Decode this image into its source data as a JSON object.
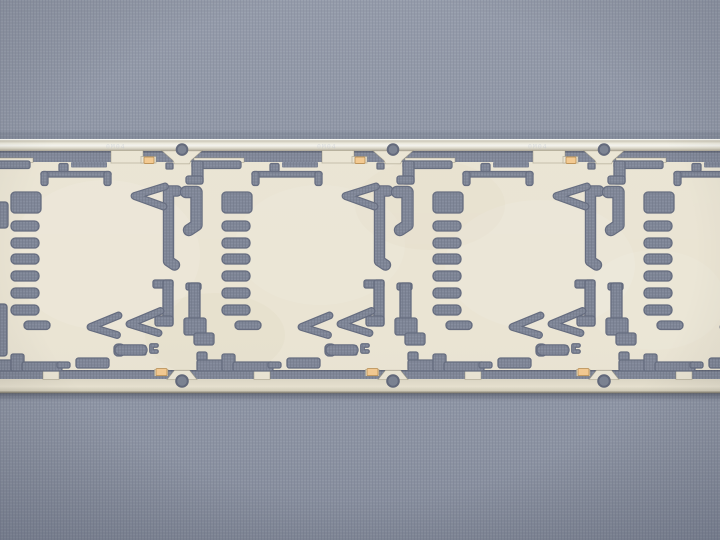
{
  "photo": {
    "kind": "macro photograph of an etched metal lead-frame carrier strip on woven gray paper",
    "width": 720,
    "height": 540,
    "rail_mark_text": "0M04"
  },
  "colors": {
    "bg_base": "#8e95a4",
    "bg_weave_light": "#9aa1b0",
    "bg_weave_dark": "#808798",
    "cut_base": "#7e8596",
    "cut_weave_light": "#8a91a1",
    "cut_weave_dark": "#6f7687",
    "cut_edge": "#646b7e",
    "cream": "#eae4d3",
    "cream_edge": "rgba(150,142,118,0.55)",
    "rail_stops": [
      "#a8a290",
      "#c9c4b3",
      "#edebdf",
      "#f3f2ec",
      "#d8d4c4",
      "#a9a393"
    ],
    "brail_stops": [
      "#ddd7c5",
      "#e7e1cf",
      "#d0cab7",
      "#a39d8b"
    ],
    "rail_highlight": "#f6f6f2",
    "pad_fill": "#f3c98f",
    "pad_edge": "#bd9257",
    "hole_fill": "#798090",
    "hole_edge": "#5f6678",
    "slot_shadow": "rgba(40,45,60,0.32)",
    "strip_shadow": "rgba(45,50,65,0.45)",
    "above_shadow": "rgba(50,55,70,0.12)",
    "bottom_edge_line": "#8f8a7b",
    "mark_fill": "#b9bfcc",
    "mottle_light": "#ffffff",
    "mottle_tan": "#d8cdae",
    "vignette": "rgba(28,33,52,0.15)"
  },
  "strip": {
    "top": 139,
    "bottom": 393,
    "rail_top_y": 139,
    "rail_top_h": 12,
    "slot_top_y": 151,
    "slot_top_h": 11,
    "slot_bot_y": 370,
    "slot_bot_h": 9,
    "rail_bot_y": 379,
    "rail_bot_h": 14,
    "shadow_h": 8
  },
  "units": {
    "pitch": 211,
    "boundaries": [
      -29,
      182,
      393,
      604
    ]
  },
  "unit": {
    "fills": [
      [
        10,
        161,
        49,
        7.5,
        2
      ],
      [
        10,
        161,
        11,
        23,
        2
      ],
      [
        4,
        176,
        17,
        8,
        2.5
      ],
      [
        70,
        171.5,
        70,
        5.5,
        2.5
      ],
      [
        70,
        171.5,
        7,
        14,
        2.5
      ],
      [
        133,
        171.5,
        7,
        14,
        2.5
      ],
      [
        88,
        163.5,
        9,
        8,
        1.5
      ],
      [
        40,
        192,
        30,
        21,
        4
      ],
      [
        40,
        221,
        28,
        10,
        4.5
      ],
      [
        40,
        238,
        28,
        10,
        4.5
      ],
      [
        40,
        254,
        28,
        10,
        4.5
      ],
      [
        40,
        271,
        28,
        10,
        4.5
      ],
      [
        40,
        288,
        28,
        10,
        4.5
      ],
      [
        40,
        305,
        28,
        10,
        4.5
      ],
      [
        53,
        321,
        26,
        8.5,
        4
      ],
      [
        195,
        163,
        7,
        6,
        1
      ],
      [
        4,
        283,
        15,
        7,
        2
      ],
      [
        7,
        283,
        11,
        39,
        2
      ],
      [
        2,
        318,
        22,
        17,
        2.5
      ],
      [
        12,
        333,
        20,
        12,
        2.5
      ],
      [
        182,
        280,
        20,
        8,
        2
      ],
      [
        192,
        280,
        10,
        46,
        2
      ],
      [
        184,
        316,
        18,
        10,
        2.5
      ],
      [
        15,
        352,
        10,
        9,
        2
      ],
      [
        15,
        360,
        33,
        11,
        2
      ],
      [
        40,
        354,
        13,
        17,
        2
      ],
      [
        51,
        362,
        40,
        9,
        2
      ],
      [
        86,
        362,
        13,
        6,
        2
      ],
      [
        105,
        358,
        33,
        10,
        2.5
      ],
      [
        143,
        344,
        10.5,
        12,
        4
      ],
      [
        170.5,
        345.5,
        4.5,
        9.5,
        1.5
      ]
    ],
    "strokes": [
      {
        "d": "M4 192 H14.5 V225 L7 230",
        "w": 10
      },
      {
        "d": "M206 191 H197.5 V261 L203.5 265",
        "w": 9
      },
      {
        "d": "M194 186.5 L163.5 196 L192.5 206.5",
        "w": 5.5
      },
      {
        "d": "M147.5 315.5 L119.5 327 L146 335",
        "w": 5.5
      },
      {
        "d": "M189.5 311 L158.5 324 L187.5 333",
        "w": 5.5
      },
      {
        "d": "M149 350 H171",
        "w": 9
      },
      {
        "d": "M185.5 345.5 H180.5 V351.5 H185.5",
        "w": 2.4
      }
    ],
    "gray_notches": [
      [
        100,
        162,
        36,
        5.5,
        1
      ]
    ],
    "cream_tabs": [
      [
        12,
        158,
        50,
        4.5,
        0
      ],
      [
        140,
        150.5,
        32,
        12.5,
        0
      ],
      [
        170,
        156.5,
        15,
        6.5,
        0
      ],
      [
        72,
        369.5,
        16,
        10,
        0
      ],
      [
        183.5,
        369.5,
        13.5,
        6.5,
        0
      ]
    ],
    "flare_top": "M-20 150.8 L20 150.8 L9 160.5 L7.5 163.8 L-7.5 163.8 L-9 160.5 Z",
    "flare_bottom": "M-15 379.6 L15 379.6 L7.5 370.3 L-7.5 370.3 Z",
    "pads": [
      [
        173,
        157,
        10,
        6.5
      ],
      [
        185,
        368.6,
        11,
        7
      ]
    ],
    "hole_top": [
      0,
      149.6,
      5.3
    ],
    "hole_bottom": [
      0,
      381,
      5.8
    ],
    "mark_dx": -76,
    "mark_y": 148.5
  },
  "edge_slivers": [
    [
      -4,
      202,
      12,
      26,
      3
    ],
    [
      -4,
      304,
      11,
      52,
      3
    ]
  ],
  "mottle": [
    [
      105,
      255,
      95,
      75,
      "light",
      0.1
    ],
    [
      320,
      245,
      85,
      60,
      "light",
      0.08
    ],
    [
      540,
      265,
      95,
      65,
      "light",
      0.09
    ],
    [
      215,
      335,
      70,
      42,
      "tan",
      0.13
    ],
    [
      430,
      205,
      75,
      45,
      "tan",
      0.1
    ],
    [
      655,
      300,
      70,
      50,
      "light",
      0.08
    ]
  ]
}
